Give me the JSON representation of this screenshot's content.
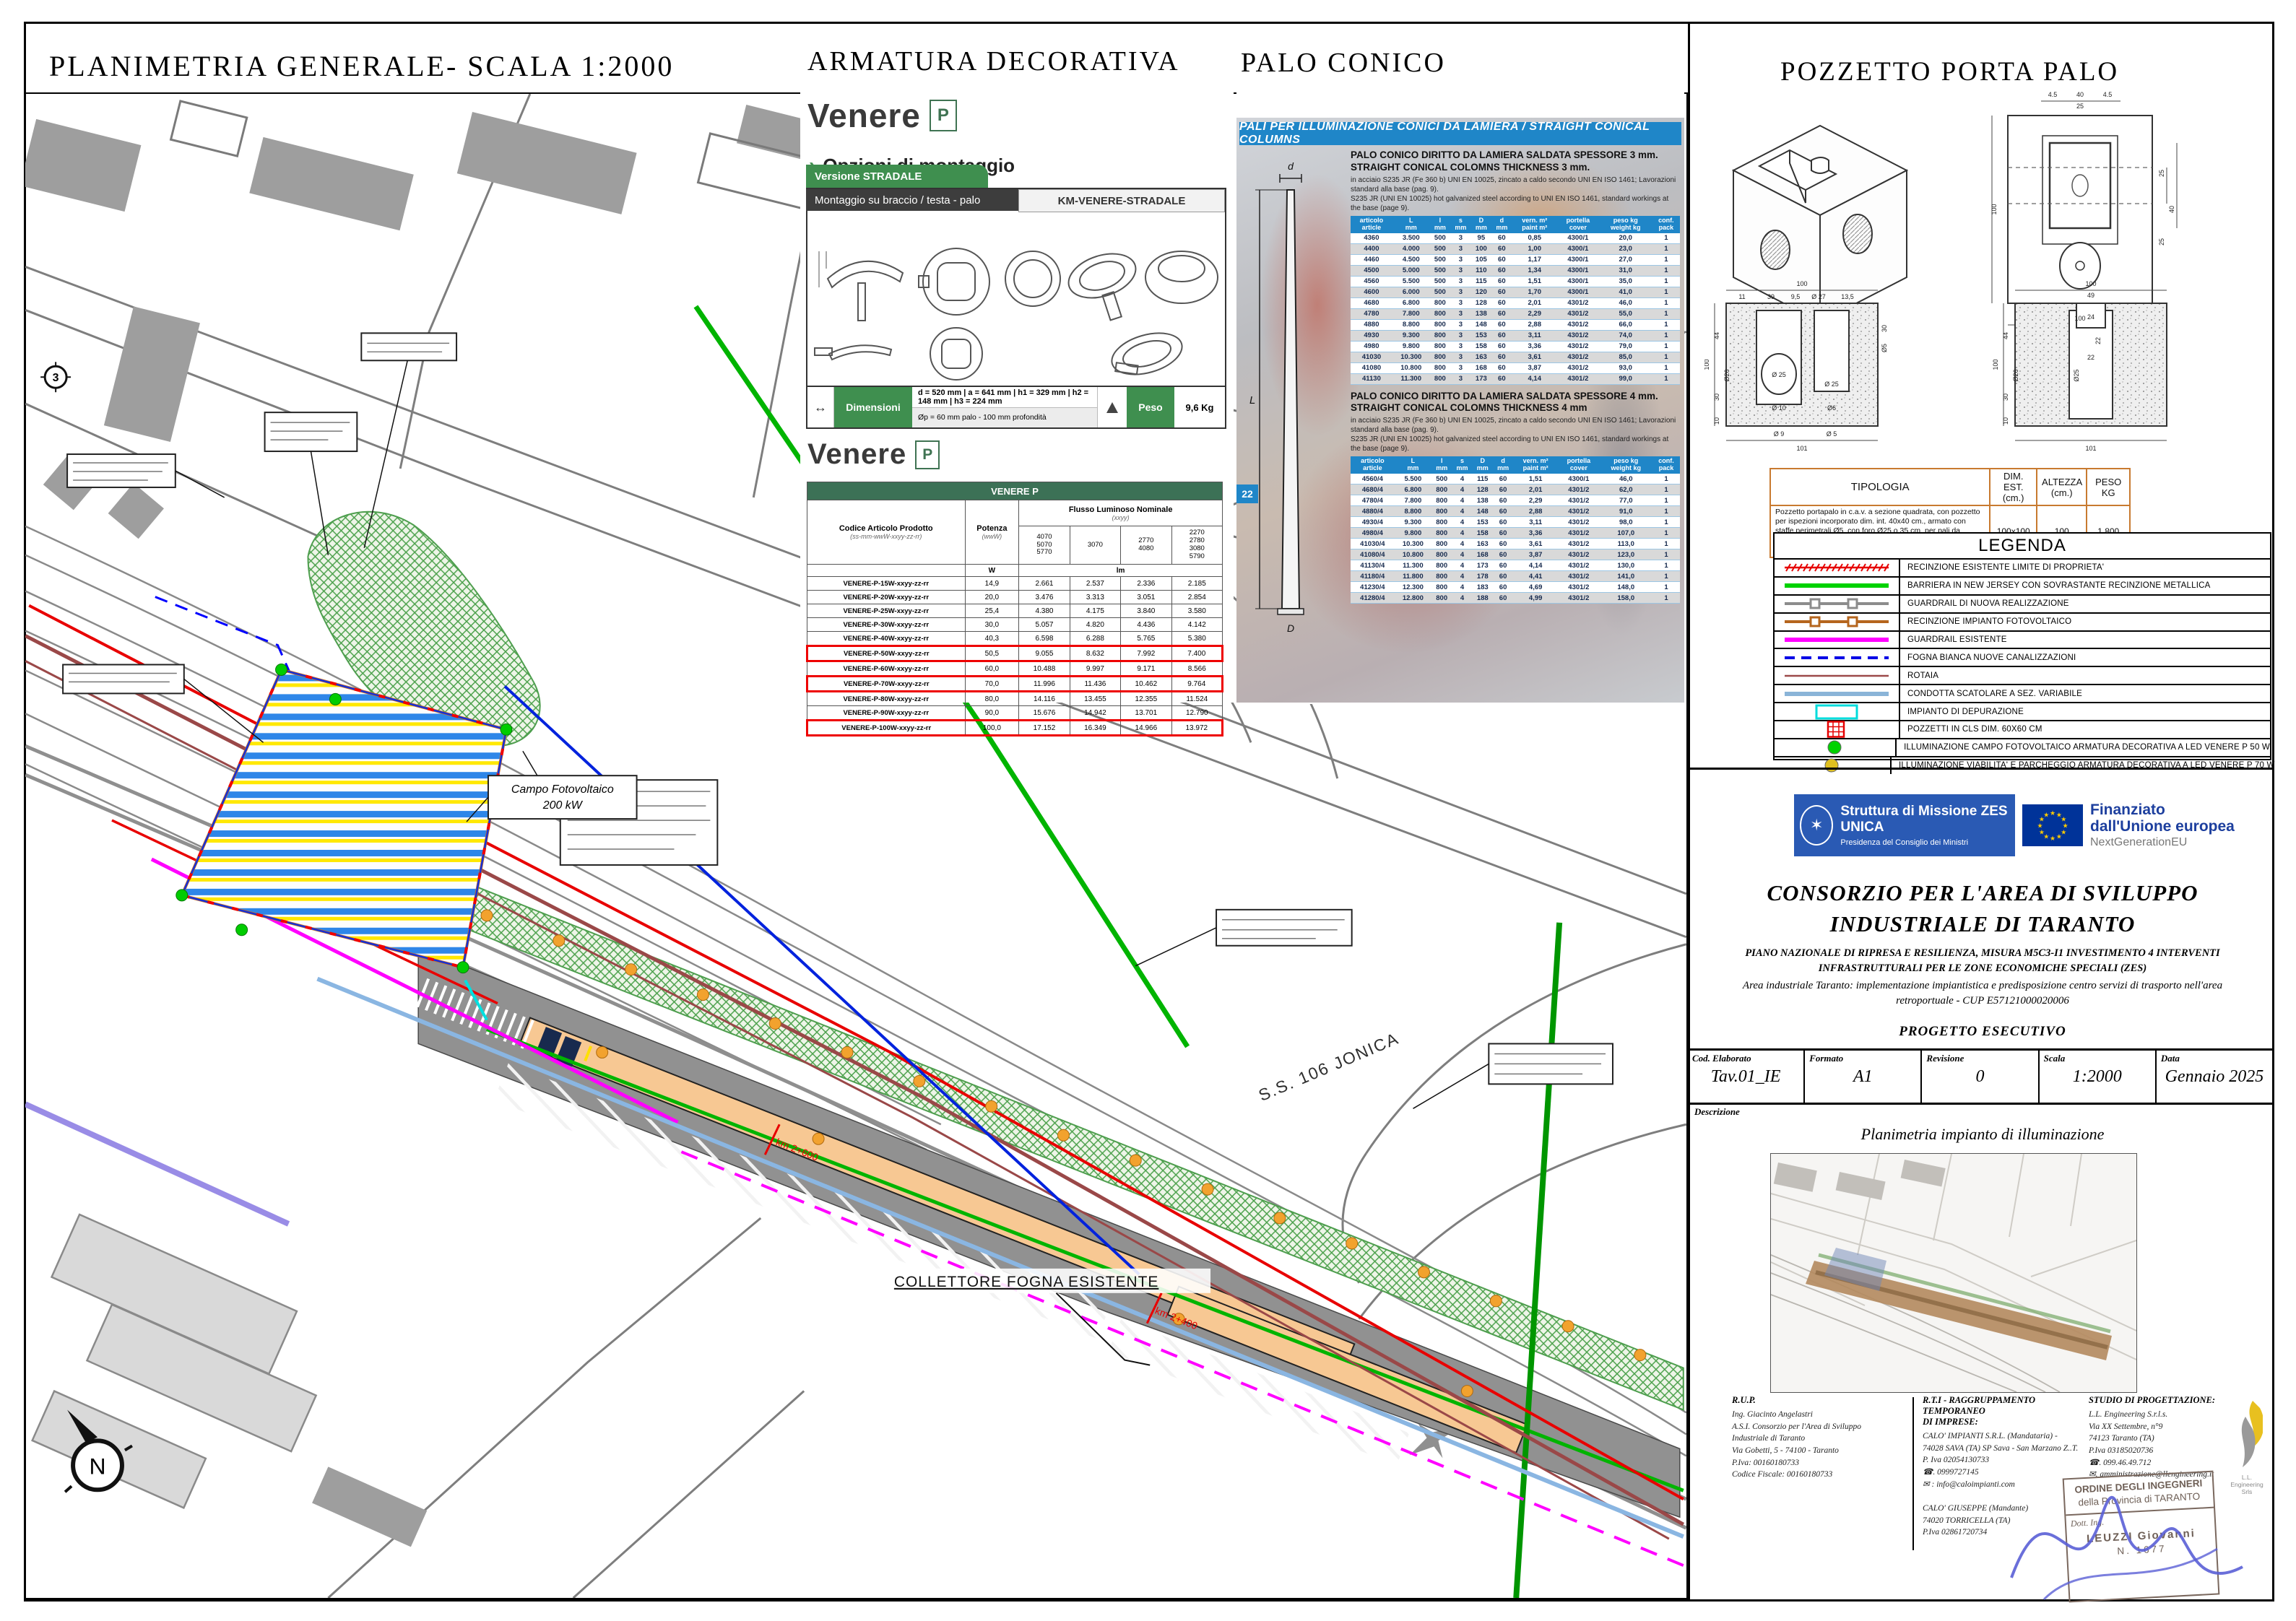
{
  "sheet": {
    "plan_title": "PLANIMETRIA GENERALE- SCALA 1:2000"
  },
  "icons": {
    "chevron": "›",
    "dim_arrow": "↔"
  },
  "map": {
    "collettore": "COLLETTORE FOGNA ESISTENTE",
    "ss106": "S.S. 106 JONICA",
    "pv_line1": "Campo Fotovoltaico",
    "pv_line2": "200 kW",
    "km_a": "km 2+600",
    "km_b": "km 2+400",
    "north": "N",
    "marker3": "3"
  },
  "armatura": {
    "title": "ARMATURA DECORATIVA",
    "brand": "Venere",
    "badge": "P",
    "options": "Opzioni di montaggio",
    "tab_version": "Versione STRADALE",
    "tab_mount": "Montaggio su braccio / testa - palo",
    "tab_model": "KM-VENERE-STRADALE",
    "dim_label": "Dimensioni",
    "dims1": "d = 520 mm   |   a = 641 mm   |   h1 = 329 mm   |   h2 = 148 mm   |   h3 = 224 mm",
    "dims2": "Øp = 60 mm palo - 100 mm profondità",
    "peso_label": "Peso",
    "peso": "9,6 Kg"
  },
  "venere_table": {
    "title": "VENERE P",
    "h_code": "Codice Articolo Prodotto",
    "h_code_sub": "(ss-mm-wwW-xxyy-zz-rr)",
    "h_power": "Potenza",
    "h_power_sub": "(wwW)",
    "h_flux": "Flusso Luminoso Nominale",
    "h_flux_sub": "(xxyy)",
    "flux_cols": [
      "4070\n5070\n5770",
      "3070",
      "2770\n4080",
      "2270\n2780\n3080\n5790"
    ],
    "unit_power": "W",
    "unit_flux": "lm",
    "rows": [
      {
        "c": "VENERE-P-15W-xxyy-zz-rr",
        "v": [
          "14,9",
          "2.661",
          "2.537",
          "2.336",
          "2.185"
        ],
        "hl": false
      },
      {
        "c": "VENERE-P-20W-xxyy-zz-rr",
        "v": [
          "20,0",
          "3.476",
          "3.313",
          "3.051",
          "2.854"
        ],
        "hl": false
      },
      {
        "c": "VENERE-P-25W-xxyy-zz-rr",
        "v": [
          "25,4",
          "4.380",
          "4.175",
          "3.840",
          "3.580"
        ],
        "hl": false
      },
      {
        "c": "VENERE-P-30W-xxyy-zz-rr",
        "v": [
          "30,0",
          "5.057",
          "4.820",
          "4.436",
          "4.142"
        ],
        "hl": false
      },
      {
        "c": "VENERE-P-40W-xxyy-zz-rr",
        "v": [
          "40,3",
          "6.598",
          "6.288",
          "5.765",
          "5.380"
        ],
        "hl": false
      },
      {
        "c": "VENERE-P-50W-xxyy-zz-rr",
        "v": [
          "50,5",
          "9.055",
          "8.632",
          "7.992",
          "7.400"
        ],
        "hl": true
      },
      {
        "c": "VENERE-P-60W-xxyy-zz-rr",
        "v": [
          "60,0",
          "10.488",
          "9.997",
          "9.171",
          "8.566"
        ],
        "hl": false
      },
      {
        "c": "VENERE-P-70W-xxyy-zz-rr",
        "v": [
          "70,0",
          "11.996",
          "11.436",
          "10.462",
          "9.764"
        ],
        "hl": true
      },
      {
        "c": "VENERE-P-80W-xxyy-zz-rr",
        "v": [
          "80,0",
          "14.116",
          "13.455",
          "12.355",
          "11.524"
        ],
        "hl": false
      },
      {
        "c": "VENERE-P-90W-xxyy-zz-rr",
        "v": [
          "90,0",
          "15.676",
          "14.942",
          "13.701",
          "12.790"
        ],
        "hl": false
      },
      {
        "c": "VENERE-P-100W-xxyy-zz-rr",
        "v": [
          "100,0",
          "17.152",
          "16.349",
          "14.966",
          "13.972"
        ],
        "hl": true
      }
    ]
  },
  "palo": {
    "title": "PALO CONICO",
    "banner": "PALI PER ILLUMINAZIONE CONICI DA LAMIERA / STRAIGHT CONICAL COLUMNS",
    "h3_it": "PALO CONICO DIRITTO DA LAMIERA SALDATA SPESSORE 3 mm.",
    "h3_en": "STRAIGHT CONICAL COLOMNS THICKNESS 3 mm.",
    "h4_it": "PALO CONICO DIRITTO DA LAMIERA SALDATA SPESSORE 4 mm.",
    "h4_en": "STRAIGHT CONICAL COLOMNS THICKNESS 4 mm",
    "desc_it": "in acciaio S235 JR (Fe 360 b) UNI EN 10025, zincato a caldo secondo UNI EN ISO 1461; Lavorazioni standard alla base (pag. 9).",
    "desc_en": "S235 JR (UNI EN 10025) hot galvanized steel according to UNI EN ISO 1461, standard workings at the base (page 9).",
    "pole": {
      "d": "d",
      "L": "L",
      "D": "D",
      "badge": "22"
    },
    "cols": [
      [
        "articolo",
        "article"
      ],
      [
        "L",
        "mm"
      ],
      [
        "l",
        "mm"
      ],
      [
        "s",
        "mm"
      ],
      [
        "D",
        "mm"
      ],
      [
        "d",
        "mm"
      ],
      [
        "vern. m²",
        "paint m²"
      ],
      [
        "portella",
        "cover"
      ],
      [
        "peso kg",
        "weight kg"
      ],
      [
        "conf.",
        "pack"
      ]
    ],
    "rows3": [
      [
        "4360",
        "3.500",
        "500",
        "3",
        "95",
        "60",
        "0,85",
        "4300/1",
        "20,0",
        "1"
      ],
      [
        "4400",
        "4.000",
        "500",
        "3",
        "100",
        "60",
        "1,00",
        "4300/1",
        "23,0",
        "1"
      ],
      [
        "4460",
        "4.500",
        "500",
        "3",
        "105",
        "60",
        "1,17",
        "4300/1",
        "27,0",
        "1"
      ],
      [
        "4500",
        "5.000",
        "500",
        "3",
        "110",
        "60",
        "1,34",
        "4300/1",
        "31,0",
        "1"
      ],
      [
        "4560",
        "5.500",
        "500",
        "3",
        "115",
        "60",
        "1,51",
        "4300/1",
        "35,0",
        "1"
      ],
      [
        "4600",
        "6.000",
        "500",
        "3",
        "120",
        "60",
        "1,70",
        "4300/1",
        "41,0",
        "1"
      ],
      [
        "4680",
        "6.800",
        "800",
        "3",
        "128",
        "60",
        "2,01",
        "4301/2",
        "46,0",
        "1"
      ],
      [
        "4780",
        "7.800",
        "800",
        "3",
        "138",
        "60",
        "2,29",
        "4301/2",
        "55,0",
        "1"
      ],
      [
        "4880",
        "8.800",
        "800",
        "3",
        "148",
        "60",
        "2,88",
        "4301/2",
        "66,0",
        "1"
      ],
      [
        "4930",
        "9.300",
        "800",
        "3",
        "153",
        "60",
        "3,11",
        "4301/2",
        "74,0",
        "1"
      ],
      [
        "4980",
        "9.800",
        "800",
        "3",
        "158",
        "60",
        "3,36",
        "4301/2",
        "79,0",
        "1"
      ],
      [
        "41030",
        "10.300",
        "800",
        "3",
        "163",
        "60",
        "3,61",
        "4301/2",
        "85,0",
        "1"
      ],
      [
        "41080",
        "10.800",
        "800",
        "3",
        "168",
        "60",
        "3,87",
        "4301/2",
        "93,0",
        "1"
      ],
      [
        "41130",
        "11.300",
        "800",
        "3",
        "173",
        "60",
        "4,14",
        "4301/2",
        "99,0",
        "1"
      ]
    ],
    "rows4": [
      [
        "4560/4",
        "5.500",
        "500",
        "4",
        "115",
        "60",
        "1,51",
        "4300/1",
        "46,0",
        "1"
      ],
      [
        "4680/4",
        "6.800",
        "800",
        "4",
        "128",
        "60",
        "2,01",
        "4301/2",
        "62,0",
        "1"
      ],
      [
        "4780/4",
        "7.800",
        "800",
        "4",
        "138",
        "60",
        "2,29",
        "4301/2",
        "77,0",
        "1"
      ],
      [
        "4880/4",
        "8.800",
        "800",
        "4",
        "148",
        "60",
        "2,88",
        "4301/2",
        "91,0",
        "1"
      ],
      [
        "4930/4",
        "9.300",
        "800",
        "4",
        "153",
        "60",
        "3,11",
        "4301/2",
        "98,0",
        "1"
      ],
      [
        "4980/4",
        "9.800",
        "800",
        "4",
        "158",
        "60",
        "3,36",
        "4301/2",
        "107,0",
        "1"
      ],
      [
        "41030/4",
        "10.300",
        "800",
        "4",
        "163",
        "60",
        "3,61",
        "4301/2",
        "113,0",
        "1"
      ],
      [
        "41080/4",
        "10.800",
        "800",
        "4",
        "168",
        "60",
        "3,87",
        "4301/2",
        "123,0",
        "1"
      ],
      [
        "41130/4",
        "11.300",
        "800",
        "4",
        "173",
        "60",
        "4,14",
        "4301/2",
        "130,0",
        "1"
      ],
      [
        "41180/4",
        "11.800",
        "800",
        "4",
        "178",
        "60",
        "4,41",
        "4301/2",
        "141,0",
        "1"
      ],
      [
        "41230/4",
        "12.300",
        "800",
        "4",
        "183",
        "60",
        "4,69",
        "4301/2",
        "148,0",
        "1"
      ],
      [
        "41280/4",
        "12.800",
        "800",
        "4",
        "188",
        "60",
        "4,99",
        "4301/2",
        "158,0",
        "1"
      ]
    ]
  },
  "pozzetto": {
    "title": "POZZETTO PORTA PALO",
    "dims": [
      "4.5",
      "40",
      "4.5",
      "25",
      "100",
      "25",
      "40",
      "25",
      "100",
      "100",
      "11",
      "39",
      "9,5",
      "Ø 27",
      "13,5",
      "100",
      "44",
      "30",
      "10",
      "Ø26",
      "Ø 25",
      "Ø 10",
      "Ø6",
      "Ø 25",
      "30",
      "Ø5",
      "Ø 9",
      "Ø 5",
      "101",
      "100",
      "49",
      "24",
      "22",
      "22",
      "44",
      "100",
      "Ø26",
      "30",
      "10",
      "Ø25",
      "101"
    ],
    "tip_header": [
      "TIPOLOGIA",
      "DIM. EST. (cm.)",
      "ALTEZZA (cm.)",
      "PESO KG"
    ],
    "tip_desc": "Pozzetto portapalo in c.a.v. a sezione quadrata, con pozzetto per ispezioni incorporato dim. int. 40x40 cm., armato con staffe perimetrali Ø5, con foro Ø25 o 35 cm. per pali da illuminazione da 8 a 10,5m. f.t. in funzione del sito di impianto e della tipologia di posa in opera",
    "tip_dim": "100x100",
    "tip_alt": "100",
    "tip_peso": "1.800"
  },
  "legend": {
    "title": "LEGENDA",
    "items": [
      {
        "label": "RECINZIONE ESISTENTE   LIMITE DI PROPRIETA'",
        "kind": "hatch",
        "color": "#e60000"
      },
      {
        "label": "BARRIERA IN NEW JERSEY CON SOVRASTANTE RECINZIONE METALLICA",
        "kind": "line6",
        "color": "#00d200"
      },
      {
        "label": "GUARDRAIL DI NUOVA REALIZZAZIONE",
        "kind": "squares",
        "color": "#8c8c8c"
      },
      {
        "label": "RECINZIONE IMPIANTO FOTOVOLTAICO",
        "kind": "squares",
        "color": "#b5651d"
      },
      {
        "label": "GUARDRAIL ESISTENTE",
        "kind": "line6",
        "color": "#ff00ff"
      },
      {
        "label": "FOGNA BIANCA NUOVE CANALIZZAZIONI",
        "kind": "dashed",
        "color": "#0000e6"
      },
      {
        "label": "ROTAIA",
        "kind": "line3",
        "color": "#9c4a4a"
      },
      {
        "label": "CONDOTTA SCATOLARE A SEZ. VARIABILE",
        "kind": "line6",
        "color": "#8ab4d8"
      },
      {
        "label": "IMPIANTO DI DEPURAZIONE",
        "kind": "rect",
        "color": "#00dcdc"
      },
      {
        "label": "POZZETTI IN CLS DIM. 60X60 CM",
        "kind": "grid",
        "color": "#e60000"
      },
      {
        "label": "ILLUMINAZIONE CAMPO FOTOVOLTAICO   ARMATURA DECORATIVA A LED VENERE  P 50 W",
        "kind": "dot",
        "color": "#00d200"
      },
      {
        "label": "ILLUMINAZIONE VIABILITA' E PARCHEGGIO   ARMATURA DECORATIVA A LED VENERE  P 70 W",
        "kind": "dot",
        "color": "#e0c020"
      }
    ]
  },
  "titleblock": {
    "gov_title": "Struttura di Missione ZES UNICA",
    "gov_sub": "Presidenza del Consiglio dei Ministri",
    "eu_bold1": "Finanziato",
    "eu_bold2": "dall'Unione europea",
    "eu_sub": "NextGenerationEU",
    "org_line1": "CONSORZIO PER L'AREA DI SVILUPPO",
    "org_line2": "INDUSTRIALE DI TARANTO",
    "pnrr1": "PIANO NAZIONALE DI RIPRESA E RESILIENZA, MISURA M5C3-I1 INVESTIMENTO 4 INTERVENTI",
    "pnrr2": "INFRASTRUTTURALI PER LE ZONE ECONOMICHE SPECIALI (ZES)",
    "area1": "Area industriale Taranto: implementazione impiantistica e predisposizione centro servizi di trasporto nell'area",
    "area2": "retroportuale - CUP E57121000020006",
    "phase": "PROGETTO ESECUTIVO",
    "fields": [
      {
        "label": "Cod. Elaborato",
        "value": "Tav.01_IE"
      },
      {
        "label": "Formato",
        "value": "A1"
      },
      {
        "label": "Revisione",
        "value": "0"
      },
      {
        "label": "Scala",
        "value": "1:2000"
      },
      {
        "label": "Data",
        "value": "Gennaio 2025"
      }
    ],
    "descr_label": "Descrizione",
    "descr_value": "Planimetria impianto di illuminazione"
  },
  "contacts": {
    "rup": {
      "heading": "R.U.P.",
      "lines": [
        "Ing. Giacinto Angelastri",
        "A.S.I. Consorzio per l'Area di Sviluppo",
        "Industriale di Taranto",
        "Via Gobetti, 5 - 74100 - Taranto",
        "P.Iva: 00160180733",
        "Codice Fiscale: 00160180733"
      ]
    },
    "rti": {
      "heading": "R.T.I - RAGGRUPPAMENTO TEMPORANEO\nDI IMPRESE:",
      "lines": [
        "CALO' IMPIANTI S.R.L. (Mandataria) -",
        "74028 SAVA (TA) SP Sava - San Marzano Z..T.",
        "P. Iva 02054130733",
        "☎. 0999727145",
        "✉ : info@caloimpianti.com",
        "",
        "CALO' GIUSEPPE (Mandante)",
        "74020 TORRICELLA (TA)",
        "P.Iva 02861720734"
      ]
    },
    "studio": {
      "heading": "STUDIO DI PROGETTAZIONE:",
      "lines": [
        "L.L. Engineering S.r.l.s.",
        "Via XX Settembre, n°9",
        "74123 Taranto (TA)",
        "P.Iva 03185020736",
        "☎. 099.46.49.712",
        "✉. amministrazione@llengineering.it"
      ]
    },
    "logo_caption": "L.L. Engineering Srls",
    "stamp": {
      "l1": "ORDINE DEGLI INGEGNERI",
      "l2": "della Provincia di TARANTO",
      "l3": "Dott. Ing.",
      "l4": "LEUZZI Giovanni",
      "l5": "N. 1677"
    }
  }
}
